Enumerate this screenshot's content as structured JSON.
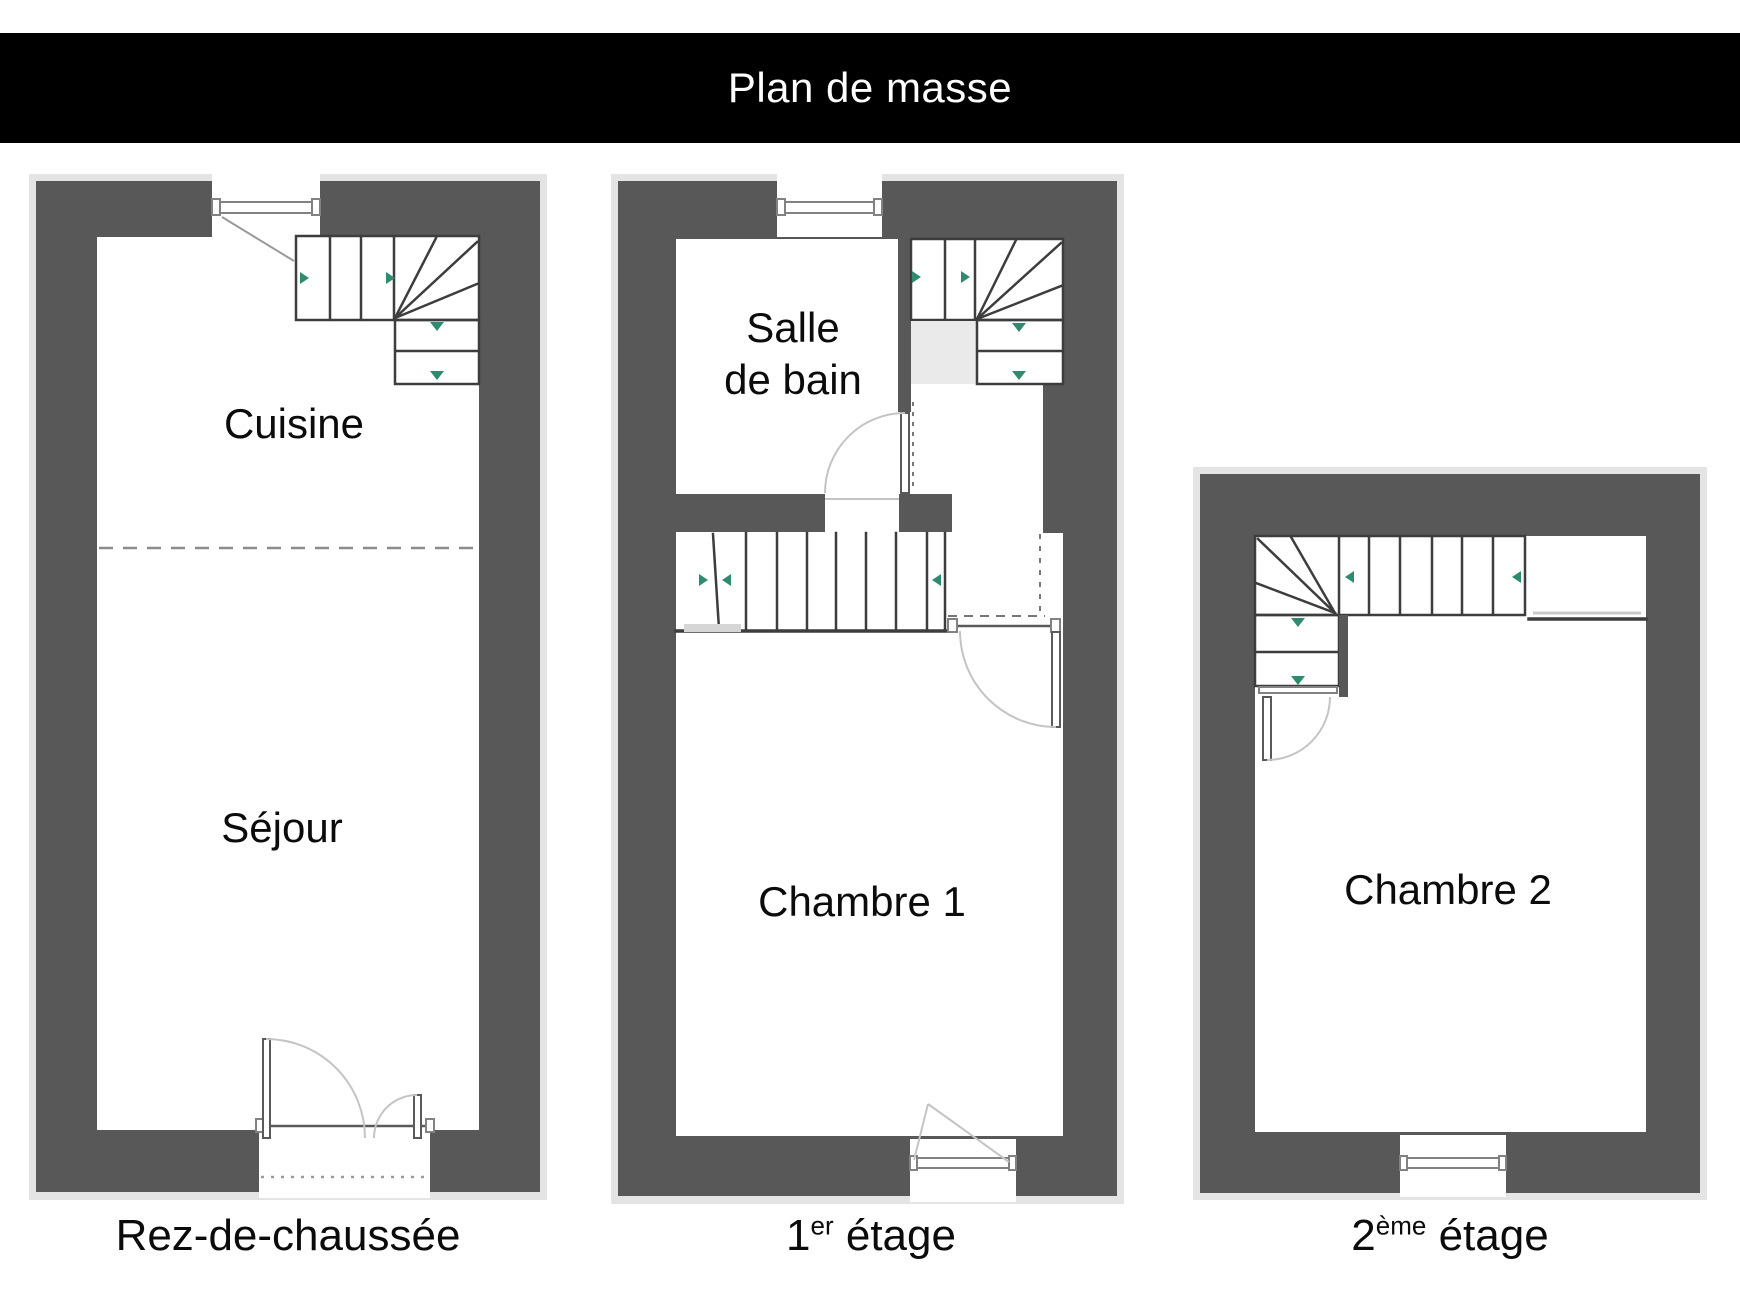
{
  "title_bar": {
    "label": "Plan de masse",
    "bg": "#000000",
    "text_color": "#ffffff"
  },
  "colors": {
    "wall": "#585858",
    "outline_halo": "#e4e4e4",
    "stair_lines": "#3d3d3d",
    "direction_arrow_green": "#2e8b70",
    "door_swing_arc": "#c4c4c4",
    "stair_landing_fill": "#eaeaea"
  },
  "floors": [
    {
      "id": "rez-de-chaussee",
      "caption": {
        "base": "Rez-de-chaussée",
        "sup": "",
        "rest": ""
      },
      "rooms": [
        {
          "name": "Cuisine"
        },
        {
          "name": "Séjour"
        }
      ]
    },
    {
      "id": "premier-etage",
      "caption": {
        "base": "1",
        "sup": "er",
        "rest": " étage"
      },
      "rooms": [
        {
          "name": "Salle de bain",
          "line1": "Salle",
          "line2": "de bain"
        },
        {
          "name": "Chambre 1"
        }
      ]
    },
    {
      "id": "deuxieme-etage",
      "caption": {
        "base": "2",
        "sup": "ème",
        "rest": " étage"
      },
      "rooms": [
        {
          "name": "Chambre 2"
        }
      ]
    }
  ]
}
